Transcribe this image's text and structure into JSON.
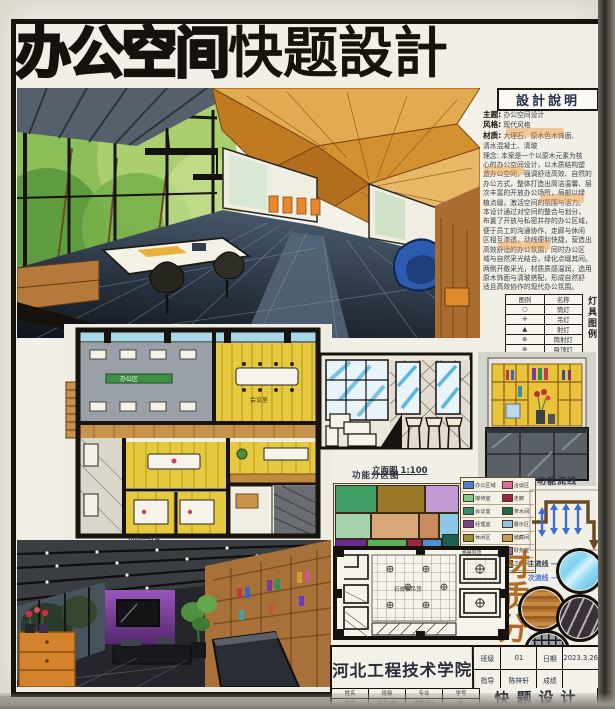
{
  "title": {
    "solid": "办公空间",
    "outline": "快题設計"
  },
  "design_notes": {
    "header": "設計說明",
    "fields": [
      {
        "label": "主题:",
        "text": "办公空间设计"
      },
      {
        "label": "风格:",
        "text": "现代风格"
      },
      {
        "label": "材质:",
        "text": "大理石、原木色木饰面、"
      },
      {
        "label": "",
        "text": "清水混凝土、清玻"
      }
    ],
    "lines": [
      "理念: 本案是一个以原木元素为核",
      "心的办公空间设计，以木质结构塑",
      "造办公空间，强调舒适高效、自然的",
      "办公方式，整体打造出简洁温馨、层",
      "次丰富的开放办公场所，局部以绿",
      "植点缀，激活空间的氛围与活力。",
      "本设计通过对空间的整合与划分，",
      "布置了开放与私密并存的办公区域，",
      "便于员工的沟通协作，走廊与休闲",
      "区相互渗透，动线便利快捷，营造出",
      "高效舒适的办公氛围，同时办公区",
      "域与自然采光结合，绿化点缀其间。",
      "两侧开敞采光，材质质感温润，选用",
      "原木饰面与清玻搭配，形成自然舒",
      "适且高效协作的现代办公氛围。"
    ]
  },
  "lighting_legend": {
    "side_label": "灯具图例",
    "col_symbol": "图例",
    "col_name": "名称",
    "rows": [
      {
        "symbol": "○",
        "name": "筒灯"
      },
      {
        "symbol": "✛",
        "name": "吊灯"
      },
      {
        "symbol": "▲",
        "name": "射灯"
      },
      {
        "symbol": "⊕",
        "name": "筒射灯"
      },
      {
        "symbol": "⊗",
        "name": "吸顶灯"
      },
      {
        "symbol": "﹣﹣﹣",
        "name": "灯带"
      }
    ]
  },
  "plan_labels": {
    "office": "办公区",
    "meeting": "会议室",
    "small_meeting": "小型会议室"
  },
  "elevation": {
    "label": "立面图",
    "scale": "1:100"
  },
  "zoning": {
    "title": "功能分区图",
    "legend": [
      {
        "name": "办公区域",
        "color": "#4a82d8"
      },
      {
        "name": "接待室",
        "color": "#7fc98a"
      },
      {
        "name": "会议室",
        "color": "#2e8f6e"
      },
      {
        "name": "经理室",
        "color": "#7a3e9e"
      },
      {
        "name": "休闲区",
        "color": "#9a8f2e"
      },
      {
        "name": "前台",
        "color": "#c03a4a"
      },
      {
        "name": "绿植区",
        "color": "#4f9e4f"
      },
      {
        "name": "洽谈区",
        "color": "#e06ca0"
      },
      {
        "name": "走廊",
        "color": "#9e2440"
      },
      {
        "name": "茶水间",
        "color": "#1f6b4a"
      },
      {
        "name": "展示区",
        "color": "#8fc3e8"
      },
      {
        "name": "储藏间",
        "color": "#c89a5e"
      },
      {
        "name": "财务室",
        "color": "#9a6ab8"
      },
      {
        "name": "卫生间",
        "color": "#8aa89a"
      }
    ],
    "blocks": [
      "#3f9e63",
      "#9a7a28",
      "#c39ad3",
      "#a6d3ae",
      "#d9a878",
      "#c98b5e",
      "#8ec6e6",
      "#6a2d8f",
      "#5cb05c",
      "#a02545",
      "#4a90d9",
      "#1d5f52",
      "#e070a8"
    ]
  },
  "circulation": {
    "title": "功能流线",
    "main": "主流线",
    "secondary": "次流线"
  },
  "materials": {
    "title": "材质分析",
    "items": [
      "清玻",
      "木饰面",
      "大理石",
      "金属格栅"
    ]
  },
  "ceiling_plan": {
    "note_center": "石膏板吊顶",
    "note_corner": "格栅吊顶"
  },
  "title_block": {
    "school": "河北工程技术学院",
    "class_label": "班级",
    "class_value": "01",
    "date_label": "日期",
    "date_value": "2023.3.26",
    "advisor_label": "指导",
    "advisor_value": "陈梓轩",
    "grade_label": "成绩",
    "grade_value": "",
    "info_headers": [
      "姓名",
      "班级",
      "专业",
      "学号"
    ],
    "info_values": [
      "张硕",
      "环艺2班",
      "环境设计",
      "9"
    ],
    "big_title": "快题设计"
  }
}
